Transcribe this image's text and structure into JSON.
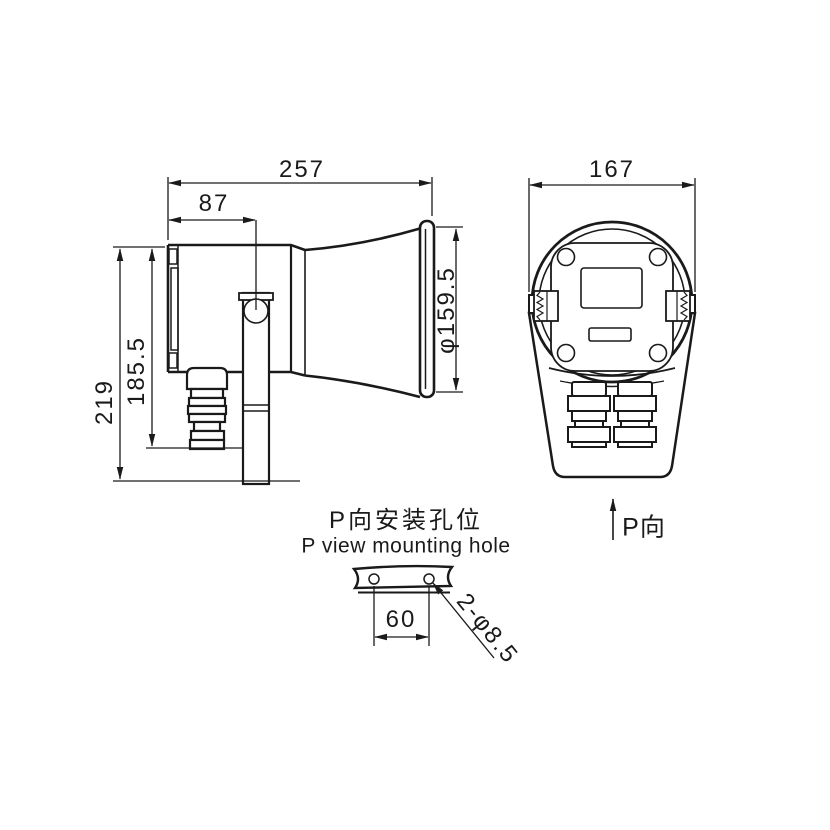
{
  "side_view": {
    "overall_length": "257",
    "mount_hole_offset": "87",
    "overall_height": "219",
    "body_height": "185.5",
    "horn_diameter": "φ159.5"
  },
  "front_view": {
    "overall_width": "167",
    "view_direction_label": "P向"
  },
  "mounting_detail": {
    "title_cn": "P向安装孔位",
    "title_en": "P view mounting hole",
    "hole_spacing": "60",
    "hole_spec": "2-φ8.5"
  },
  "style": {
    "line_color": "#1a1a1a",
    "background": "#ffffff"
  }
}
